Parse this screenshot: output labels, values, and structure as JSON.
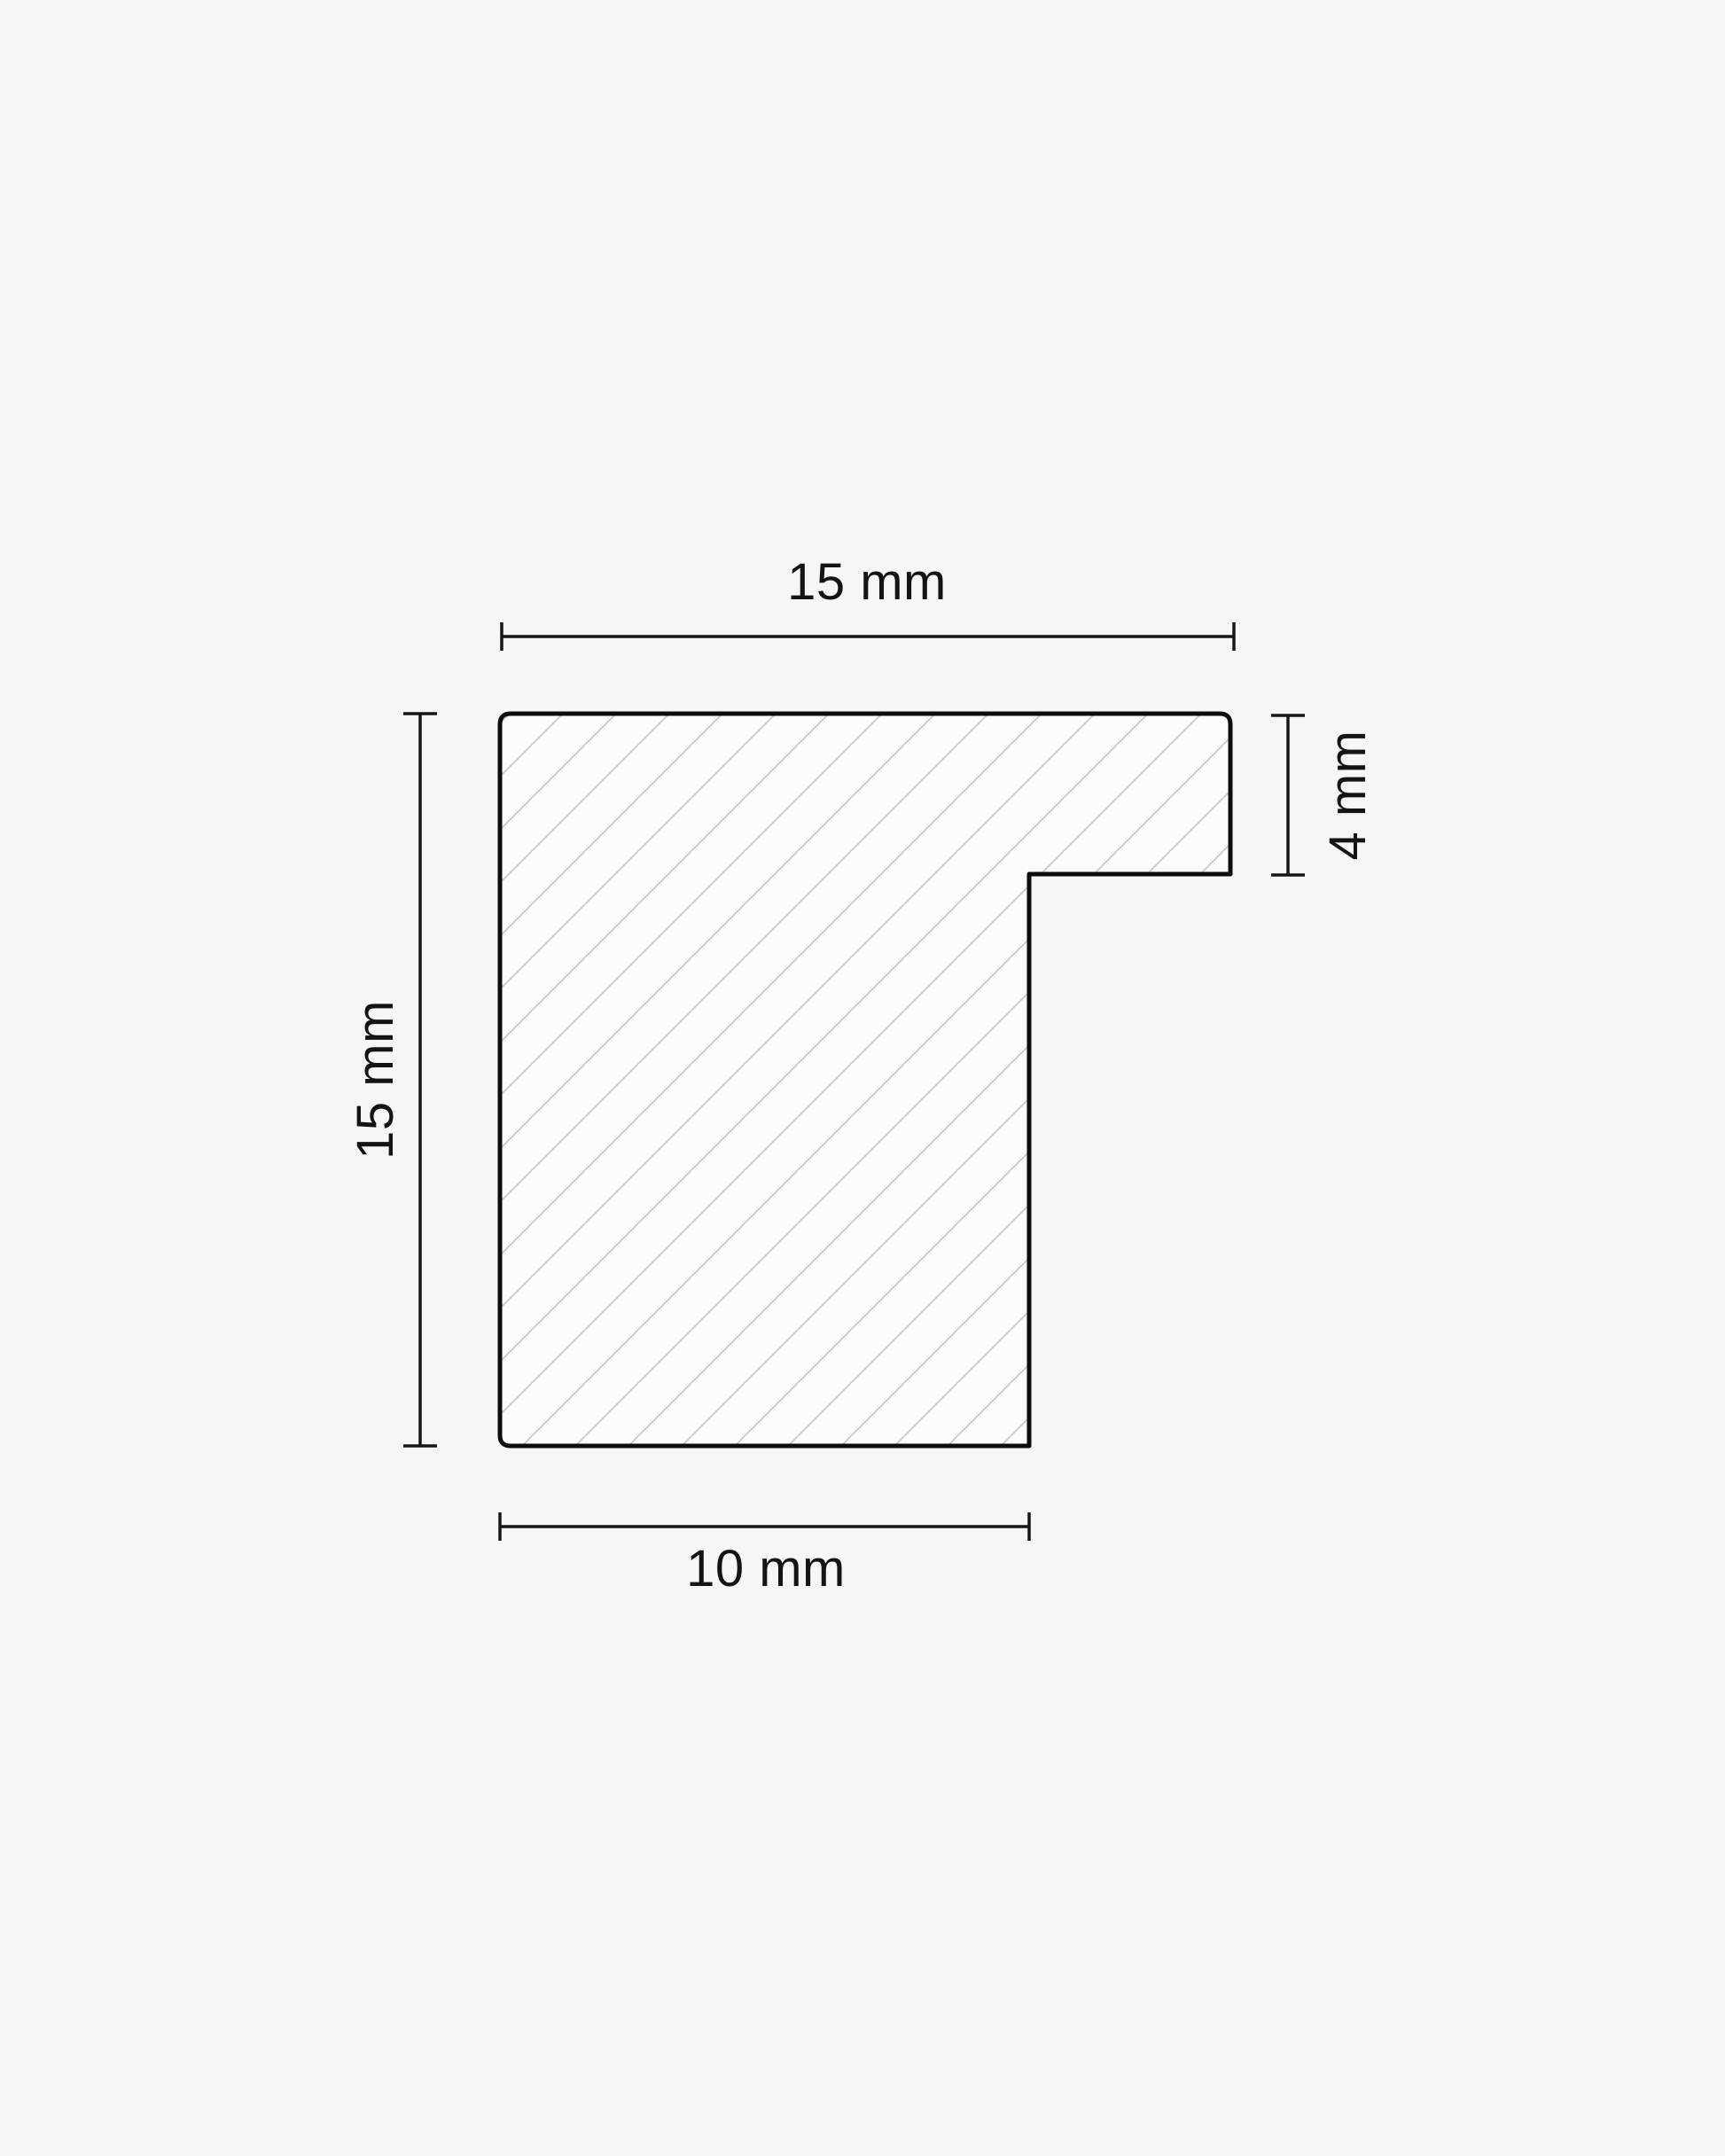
{
  "diagram": {
    "type": "frame-moulding-cross-section",
    "dimensions": {
      "top_width": {
        "label": "15 mm"
      },
      "rebate_height": {
        "label": "4 mm"
      },
      "profile_height": {
        "label": "15 mm"
      },
      "base_width": {
        "label": "10 mm"
      }
    },
    "colors": {
      "background": "#f6f6f7",
      "shape_fill": "#fcfcfd",
      "outline": "#0d0d0d",
      "hatch": "#c9c9cb",
      "dimension_lines": "#161616",
      "label_text": "#141414"
    }
  }
}
